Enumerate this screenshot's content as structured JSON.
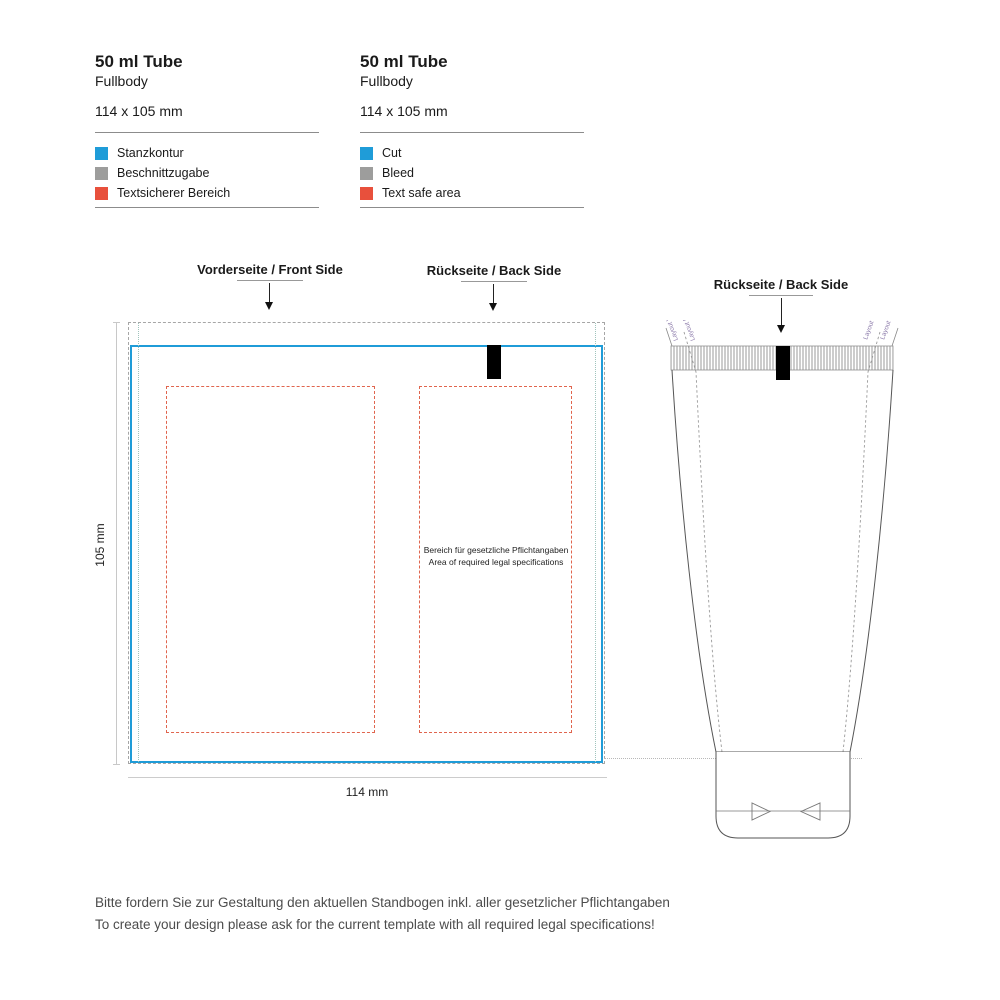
{
  "colors": {
    "cut_blue": "#1f9cd8",
    "bleed_gray": "#9d9d9c",
    "text_safe_red": "#e8503c",
    "side_label_purple": "#8d7cab"
  },
  "headers": [
    {
      "title": "50 ml Tube",
      "subtitle": "Fullbody",
      "size": "114 x 105 mm",
      "legend": [
        {
          "label": "Stanzkontur",
          "color": "#1f9cd8"
        },
        {
          "label": "Beschnittzugabe",
          "color": "#9d9d9c"
        },
        {
          "label": "Textsicherer Bereich",
          "color": "#e8503c"
        }
      ]
    },
    {
      "title": "50 ml Tube",
      "subtitle": "Fullbody",
      "size": "114 x 105 mm",
      "legend": [
        {
          "label": "Cut",
          "color": "#1f9cd8"
        },
        {
          "label": "Bleed",
          "color": "#9d9d9c"
        },
        {
          "label": "Text safe area",
          "color": "#e8503c"
        }
      ]
    }
  ],
  "dieline": {
    "front_label": "Vorderseite / Front Side",
    "back_label": "Rückseite / Back Side",
    "width_dim": "114 mm",
    "height_dim": "105 mm",
    "legal_line1": "Bereich für gesetzliche Pflichtangaben",
    "legal_line2": "Area of required legal specifications"
  },
  "tube": {
    "back_label": "Rückseite / Back Side",
    "left_outer_label": "Layout Vorderseite",
    "left_inner_label": "Layout Front",
    "right_inner_label": "Layout Front",
    "right_outer_label": "Layout Vorderseite"
  },
  "footer": {
    "line1": "Bitte fordern Sie zur Gestaltung den aktuellen Standbogen inkl. aller gesetzlicher Pflichtangaben",
    "line2": "To create your design please ask for the current template with all required legal specifications!"
  }
}
